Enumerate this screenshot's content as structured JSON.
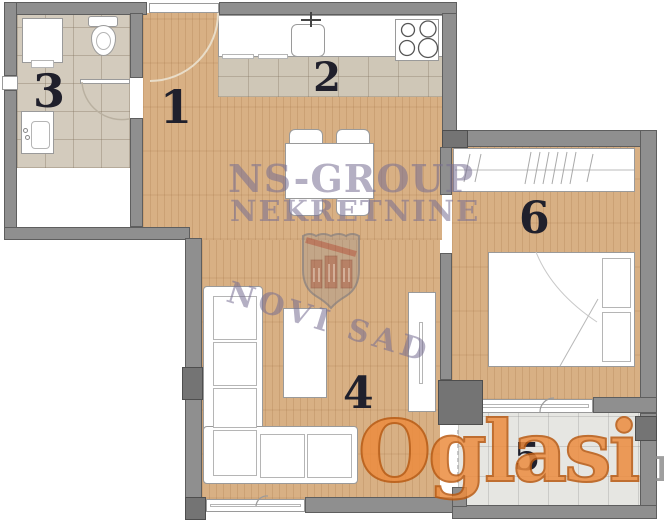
{
  "plan": {
    "type": "apartment-floor-plan",
    "rooms": [
      {
        "number": "1"
      },
      {
        "number": "2"
      },
      {
        "number": "3"
      },
      {
        "number": "4"
      },
      {
        "number": "5"
      },
      {
        "number": "6"
      }
    ],
    "watermarks": {
      "agency_line1": "NS-GROUP",
      "agency_line2": "NEKRETNINE",
      "agency_line3": "NOVI SAD",
      "site_name": "Oglasi",
      "site_tld": ".rs"
    },
    "colors": {
      "wall_gray": "#8f8f8f",
      "wall_dark": "#747474",
      "wood_floor": "#d8b084",
      "bath_tile": "#d3cbbd",
      "terrace_tile": "#e6e6e2",
      "watermark_purple": "#766e91",
      "brand_orange": "#ec8c3f",
      "number_ink": "#20202c"
    }
  }
}
